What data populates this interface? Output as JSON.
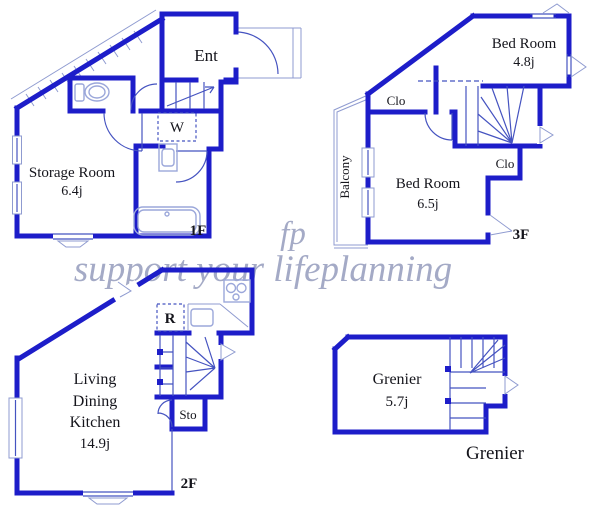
{
  "watermark": {
    "logo": "fp",
    "tagline": "support your lifeplanning"
  },
  "colors": {
    "wall": "#1d1dc9",
    "line": "#4553c0",
    "faint": "#8f9bd0",
    "fixture": "#9ba7da",
    "text": "#15151c",
    "watermark": "#a4aac6"
  },
  "floor1": {
    "floor_label": "1F",
    "entrance_label": "Ent",
    "washer_label": "W",
    "storage_room": {
      "name": "Storage Room",
      "area": "6.4j"
    }
  },
  "floor2": {
    "floor_label": "2F",
    "refrigerator_label": "R",
    "storage_label": "Sto",
    "ldk": {
      "line1": "Living",
      "line2": "Dining",
      "line3": "Kitchen",
      "area": "14.9j"
    }
  },
  "floor3": {
    "floor_label": "3F",
    "bedroom_small": {
      "name": "Bed Room",
      "area": "4.8j"
    },
    "bedroom_large": {
      "name": "Bed Room",
      "area": "6.5j"
    },
    "closet_upper_label": "Clo",
    "closet_lower_label": "Clo",
    "balcony_label": "Balcony"
  },
  "attic": {
    "caption": "Grenier",
    "room": {
      "name": "Grenier",
      "area": "5.7j"
    }
  }
}
